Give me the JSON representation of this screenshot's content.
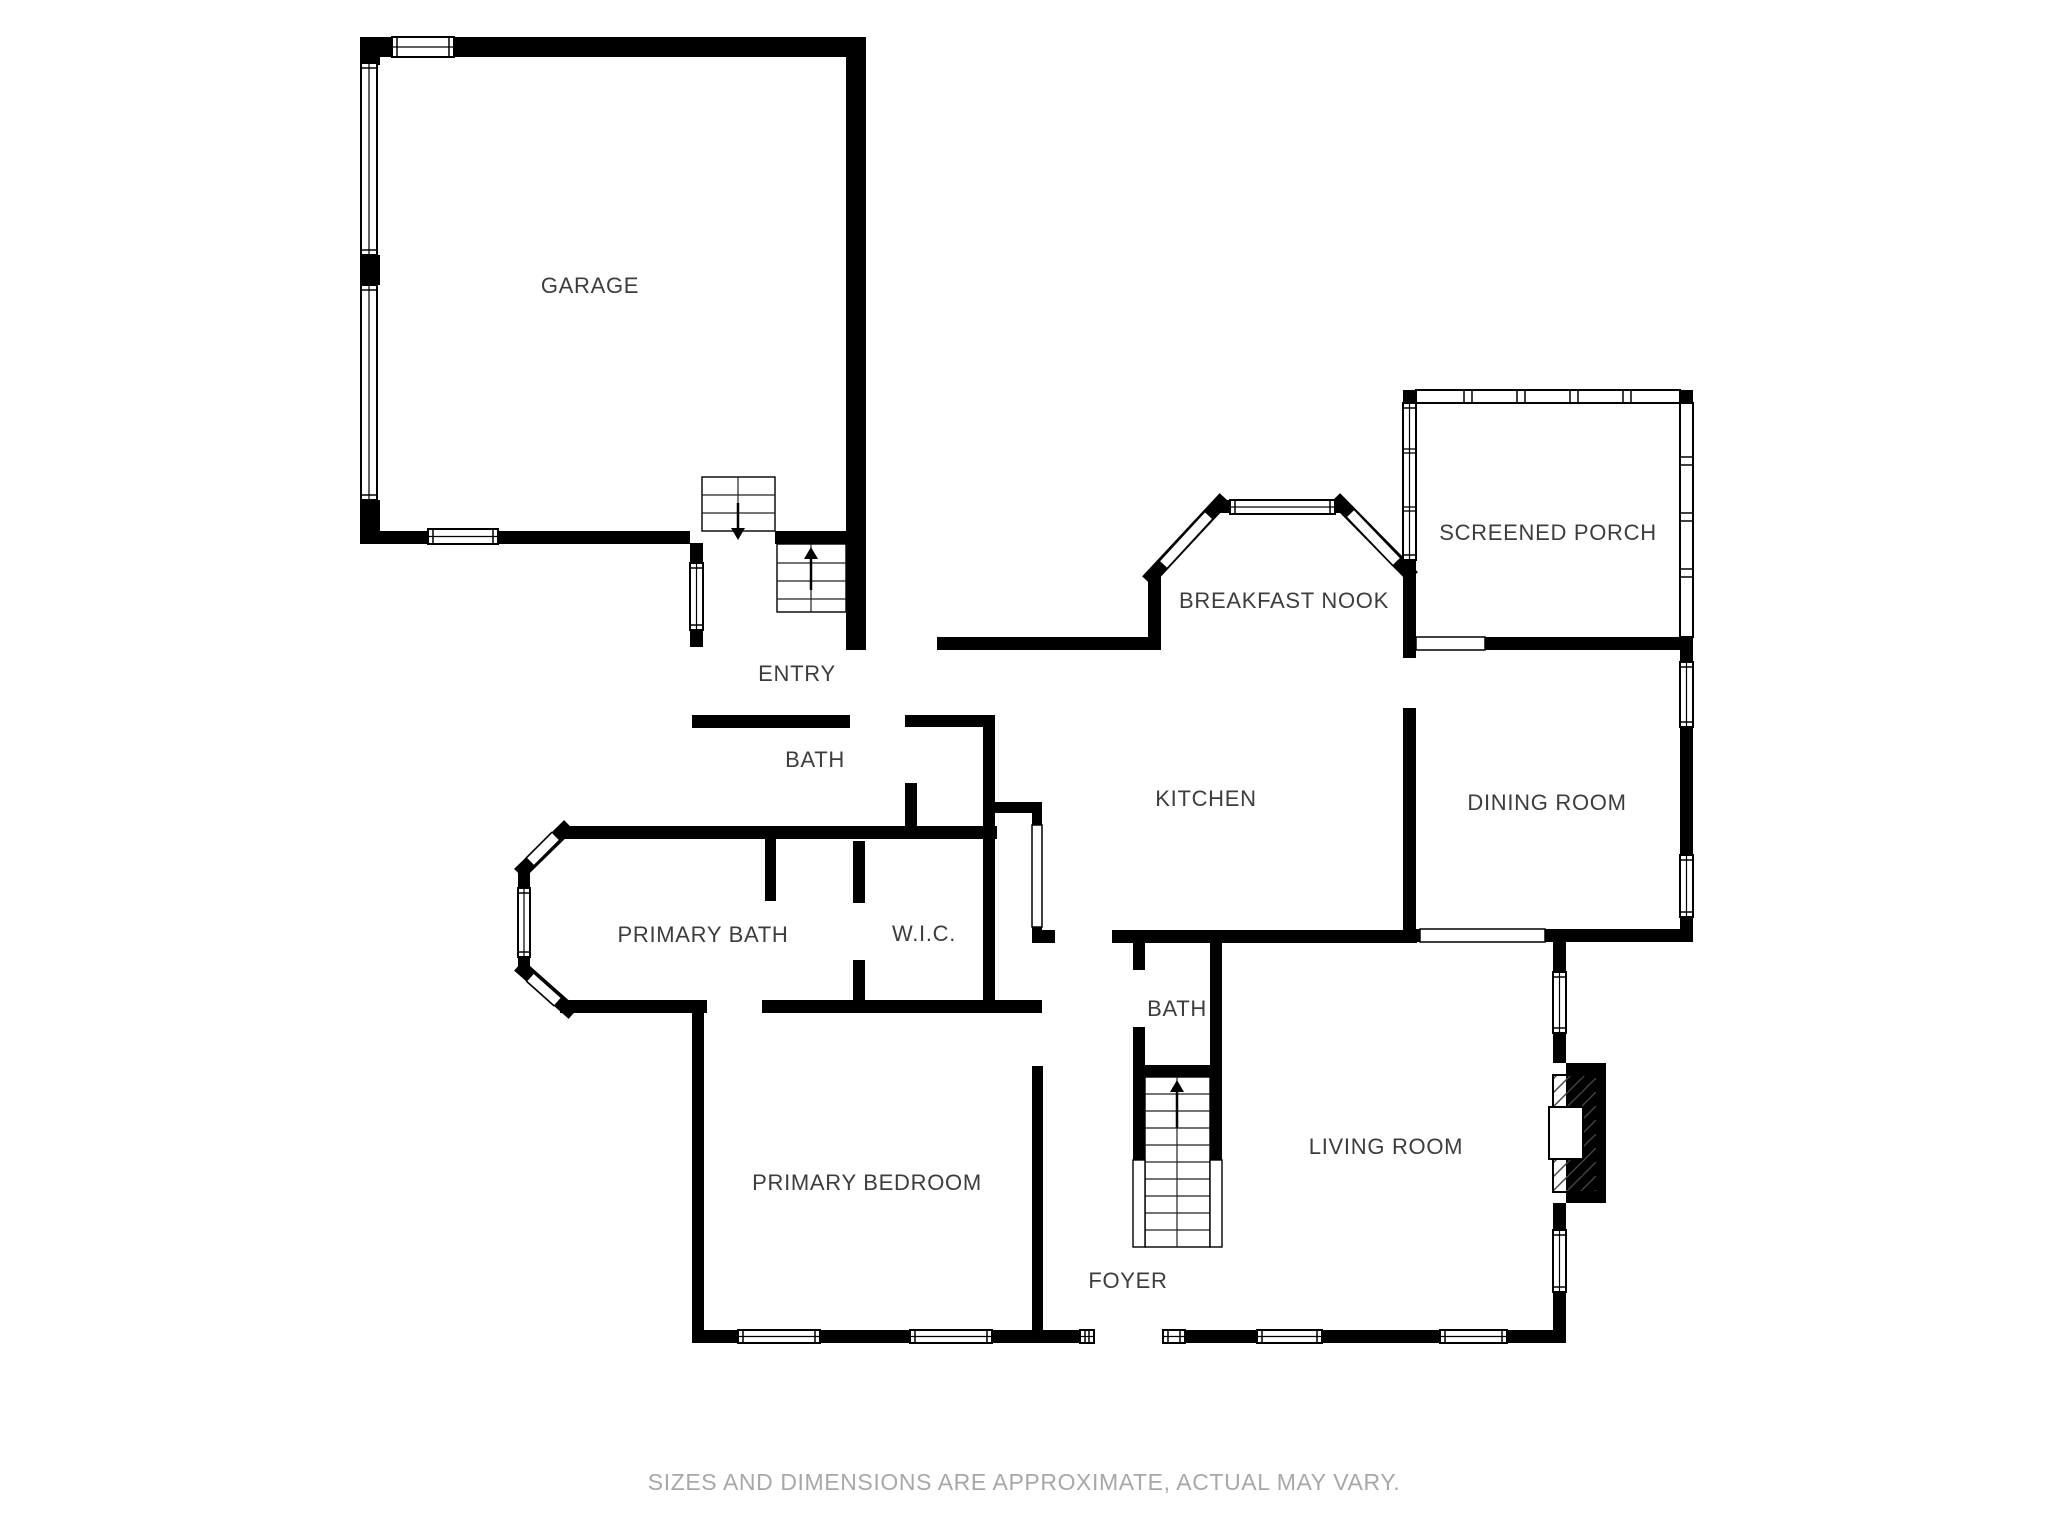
{
  "page": {
    "footer": "SIZES AND DIMENSIONS ARE APPROXIMATE, ACTUAL MAY VARY.",
    "background_color": "#ffffff",
    "wall_color": "#000000",
    "label_color": "#3d3d3d",
    "footer_color": "#a8a8a8"
  },
  "floor_plan": {
    "canvas": {
      "width": 2048,
      "height": 1536
    },
    "rooms": [
      {
        "id": "garage",
        "label": "GARAGE",
        "x": 590,
        "y": 286
      },
      {
        "id": "entry",
        "label": "ENTRY",
        "x": 797,
        "y": 674
      },
      {
        "id": "bath-upper",
        "label": "BATH",
        "x": 815,
        "y": 760
      },
      {
        "id": "breakfast-nook",
        "label": "BREAKFAST NOOK",
        "x": 1284,
        "y": 601
      },
      {
        "id": "screened-porch",
        "label": "SCREENED PORCH",
        "x": 1548,
        "y": 533
      },
      {
        "id": "kitchen",
        "label": "KITCHEN",
        "x": 1206,
        "y": 799
      },
      {
        "id": "dining-room",
        "label": "DINING ROOM",
        "x": 1547,
        "y": 803
      },
      {
        "id": "primary-bath",
        "label": "PRIMARY BATH",
        "x": 703,
        "y": 935
      },
      {
        "id": "wic",
        "label": "W.I.C.",
        "x": 924,
        "y": 934
      },
      {
        "id": "bath-lower",
        "label": "BATH",
        "x": 1177,
        "y": 1009
      },
      {
        "id": "primary-bedroom",
        "label": "PRIMARY BEDROOM",
        "x": 867,
        "y": 1183
      },
      {
        "id": "living-room",
        "label": "LIVING ROOM",
        "x": 1386,
        "y": 1147
      },
      {
        "id": "foyer",
        "label": "FOYER",
        "x": 1128,
        "y": 1281
      }
    ],
    "walls": [
      [
        360,
        37,
        506,
        20
      ],
      [
        846,
        37,
        20,
        613
      ],
      [
        360,
        37,
        20,
        28
      ],
      [
        360,
        255,
        20,
        30
      ],
      [
        360,
        500,
        20,
        44
      ],
      [
        360,
        531,
        330,
        13
      ],
      [
        775,
        531,
        71,
        13
      ],
      [
        690,
        543,
        13,
        20
      ],
      [
        690,
        630,
        13,
        17
      ],
      [
        692,
        715,
        158,
        13
      ],
      [
        937,
        637,
        224,
        13
      ],
      [
        1148,
        573,
        13,
        77
      ],
      [
        1216,
        500,
        128,
        13
      ],
      [
        1403,
        390,
        13,
        13
      ],
      [
        1403,
        560,
        13,
        90
      ],
      [
        1680,
        390,
        13,
        13
      ],
      [
        1680,
        637,
        13,
        23
      ],
      [
        1485,
        637,
        195,
        13
      ],
      [
        1403,
        650,
        13,
        8
      ],
      [
        1403,
        708,
        13,
        234
      ],
      [
        1680,
        650,
        13,
        12
      ],
      [
        1680,
        727,
        13,
        128
      ],
      [
        1680,
        917,
        13,
        25
      ],
      [
        1403,
        929,
        17,
        13
      ],
      [
        1545,
        929,
        148,
        13
      ],
      [
        1112,
        930,
        305,
        13
      ],
      [
        1032,
        930,
        23,
        13
      ],
      [
        905,
        715,
        12,
        12
      ],
      [
        905,
        783,
        12,
        56
      ],
      [
        917,
        715,
        76,
        12
      ],
      [
        983,
        715,
        12,
        124
      ],
      [
        993,
        802,
        47,
        11
      ],
      [
        1032,
        802,
        10,
        23
      ],
      [
        1032,
        927,
        10,
        16
      ],
      [
        1032,
        1002,
        10,
        11
      ],
      [
        560,
        826,
        437,
        13
      ],
      [
        765,
        839,
        11,
        62
      ],
      [
        853,
        841,
        12,
        62
      ],
      [
        853,
        960,
        12,
        53
      ],
      [
        983,
        839,
        12,
        161
      ],
      [
        560,
        1000,
        147,
        13
      ],
      [
        762,
        1000,
        280,
        13
      ],
      [
        518,
        868,
        12,
        20
      ],
      [
        518,
        957,
        12,
        15
      ],
      [
        692,
        1013,
        12,
        329
      ],
      [
        1032,
        1066,
        11,
        276
      ],
      [
        692,
        1330,
        46,
        13
      ],
      [
        820,
        1330,
        90,
        13
      ],
      [
        992,
        1330,
        88,
        13
      ],
      [
        1185,
        1330,
        72,
        13
      ],
      [
        1322,
        1330,
        118,
        13
      ],
      [
        1507,
        1330,
        59,
        13
      ],
      [
        1133,
        943,
        12,
        27
      ],
      [
        1133,
        1027,
        12,
        50
      ],
      [
        1210,
        943,
        12,
        134
      ],
      [
        1133,
        1065,
        89,
        12
      ],
      [
        1133,
        1077,
        12,
        83
      ],
      [
        1210,
        1077,
        12,
        83
      ],
      [
        1553,
        942,
        13,
        30
      ],
      [
        1553,
        1033,
        13,
        30
      ],
      [
        1553,
        1203,
        13,
        27
      ],
      [
        1553,
        1292,
        13,
        50
      ]
    ],
    "angled_walls": [
      [
        1152,
        576,
        1220,
        503
      ],
      [
        1340,
        503,
        1408,
        572
      ],
      [
        524,
        869,
        564,
        830
      ],
      [
        524,
        970,
        568,
        1009
      ]
    ],
    "windows": [
      {
        "x": 392,
        "y": 37,
        "w": 62,
        "h": 20,
        "o": "h"
      },
      {
        "x": 428,
        "y": 529,
        "w": 70,
        "h": 15,
        "o": "h"
      },
      {
        "x": 1230,
        "y": 500,
        "w": 105,
        "h": 14,
        "o": "h"
      },
      {
        "x": 738,
        "y": 1330,
        "w": 82,
        "h": 13,
        "o": "h"
      },
      {
        "x": 910,
        "y": 1330,
        "w": 82,
        "h": 13,
        "o": "h"
      },
      {
        "x": 1080,
        "y": 1330,
        "w": 14,
        "h": 13,
        "o": "h"
      },
      {
        "x": 1163,
        "y": 1330,
        "w": 22,
        "h": 13,
        "o": "h"
      },
      {
        "x": 1257,
        "y": 1330,
        "w": 65,
        "h": 13,
        "o": "h"
      },
      {
        "x": 1440,
        "y": 1330,
        "w": 67,
        "h": 13,
        "o": "h"
      },
      {
        "x": 690,
        "y": 563,
        "w": 13,
        "h": 67,
        "o": "v"
      },
      {
        "x": 518,
        "y": 888,
        "w": 12,
        "h": 69,
        "o": "v"
      },
      {
        "x": 1403,
        "y": 403,
        "w": 13,
        "h": 157,
        "o": "v",
        "div": [
          451,
          509
        ]
      },
      {
        "x": 1680,
        "y": 662,
        "w": 13,
        "h": 65,
        "o": "v"
      },
      {
        "x": 1680,
        "y": 855,
        "w": 13,
        "h": 62,
        "o": "v"
      },
      {
        "x": 1553,
        "y": 972,
        "w": 13,
        "h": 61,
        "o": "v"
      },
      {
        "x": 1553,
        "y": 1230,
        "w": 13,
        "h": 62,
        "o": "v"
      }
    ],
    "angled_windows": [
      [
        1163,
        565,
        1209,
        515
      ],
      [
        1350,
        513,
        1397,
        562
      ],
      [
        530,
        862,
        556,
        836
      ],
      [
        530,
        977,
        558,
        1002
      ]
    ],
    "screens": [
      {
        "x": 1416,
        "y": 390,
        "w": 264,
        "h": 13,
        "o": "h",
        "m": [
          1468,
          1521,
          1574,
          1627
        ]
      },
      {
        "x": 1680,
        "y": 403,
        "w": 13,
        "h": 234,
        "o": "v",
        "m": [
          461,
          517,
          573
        ]
      }
    ],
    "garage_doors": [
      {
        "x": 361,
        "y": 63,
        "w": 16,
        "h": 192,
        "o": "v"
      },
      {
        "x": 361,
        "y": 285,
        "w": 16,
        "h": 215,
        "o": "v"
      }
    ],
    "openings": [
      [
        1416,
        637,
        69,
        13
      ],
      [
        1420,
        929,
        125,
        13
      ],
      [
        1032,
        825,
        10,
        102
      ]
    ],
    "stairs": [
      {
        "x": 702,
        "y": 477,
        "w": 73,
        "h": 54,
        "treads": [
          495,
          513
        ],
        "divider": 738,
        "arrow": {
          "x": 738,
          "y1": 503,
          "y2": 540,
          "dir": "down"
        }
      },
      {
        "x": 777,
        "y": 544,
        "w": 69,
        "h": 68,
        "treads": [
          563,
          581,
          599
        ],
        "divider": 811,
        "arrow": {
          "x": 811,
          "y1": 590,
          "y2": 547,
          "dir": "up"
        }
      },
      {
        "x": 1145,
        "y": 1077,
        "w": 65,
        "h": 170,
        "treads": [
          1094,
          1111,
          1128,
          1145,
          1162,
          1179,
          1196,
          1213,
          1230
        ],
        "divider": 1177,
        "arrow": {
          "x": 1177,
          "y1": 1128,
          "y2": 1080,
          "dir": "up"
        }
      }
    ],
    "stair_rails": [
      [
        1133,
        1160,
        12,
        87
      ],
      [
        1210,
        1160,
        12,
        87
      ]
    ],
    "fireplace": {
      "outer": [
        1566,
        1063,
        40,
        140
      ],
      "hatch": [
        1553,
        1075,
        44,
        117
      ],
      "firebox": [
        1549,
        1107,
        34,
        52
      ]
    }
  }
}
